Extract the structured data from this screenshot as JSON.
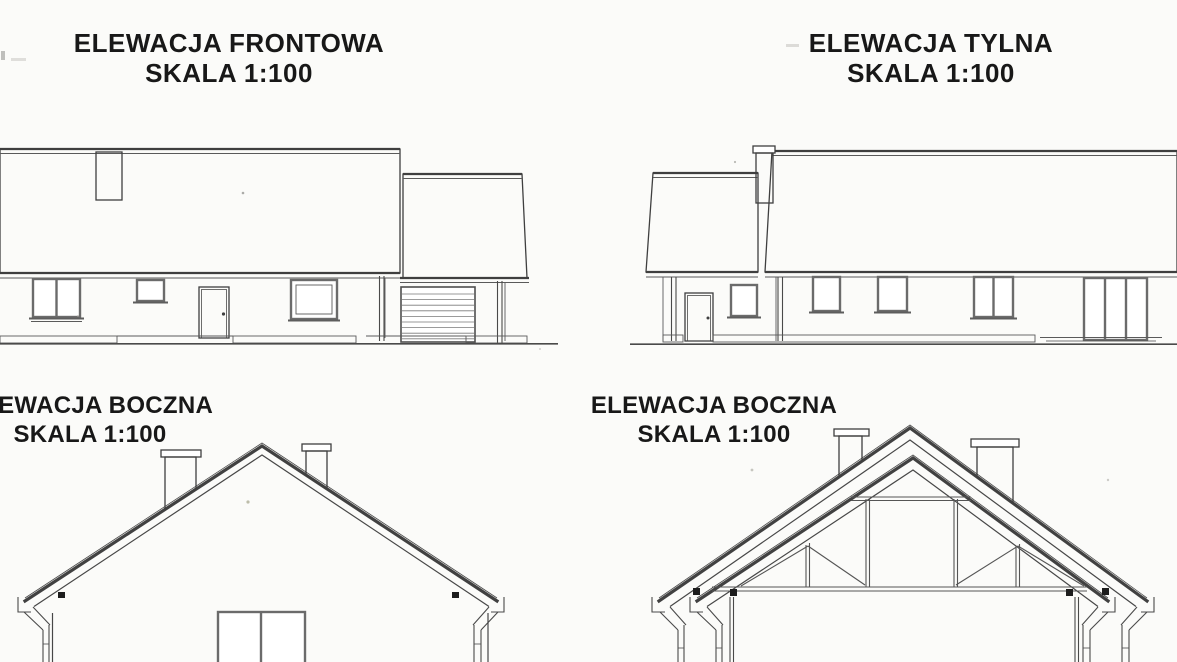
{
  "document": {
    "kind": "scanned architectural elevation sheet",
    "language": "Polish"
  },
  "elevations": [
    {
      "id": "front",
      "title": "ELEWACJA FRONTOWA",
      "scale": "SKALA 1:100"
    },
    {
      "id": "rear",
      "title": "ELEWACJA TYLNA",
      "scale": "SKALA 1:100"
    },
    {
      "id": "side-left",
      "title": "ELEWACJA BOCZNA",
      "scale": "SKALA 1:100"
    },
    {
      "id": "side-right",
      "title": "ELEWACJA BOCZNA",
      "scale": "SKALA 1:100"
    }
  ],
  "colors": {
    "paper": "#fbfbf9",
    "ink": "#3f3f3f",
    "tile_outline": "#9a9a98",
    "text": "#181818"
  }
}
